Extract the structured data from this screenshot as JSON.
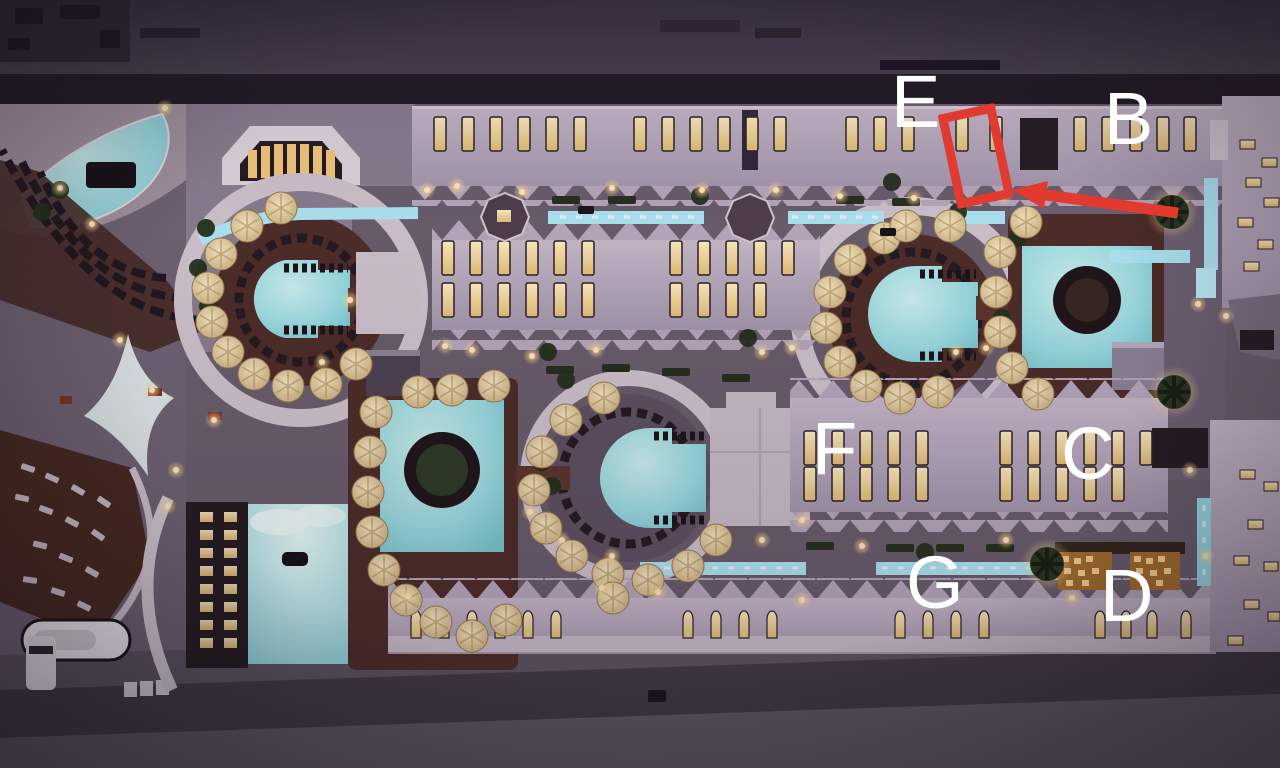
{
  "annotations": {
    "letters": [
      {
        "id": "E",
        "label": "E"
      },
      {
        "id": "B",
        "label": "B"
      },
      {
        "id": "F",
        "label": "F"
      },
      {
        "id": "C",
        "label": "C"
      },
      {
        "id": "G",
        "label": "G"
      },
      {
        "id": "D",
        "label": "D"
      }
    ],
    "marker": {
      "shape": "rotated-rectangle-outline"
    },
    "arrow": {
      "description": "red arrow pointing from right toward the rectangle marker"
    }
  },
  "colors": {
    "annotation_red": "#e03a31",
    "letter_white": "#ffffff",
    "pool_cyan": "#9adde2",
    "canal_blue": "#aee6f4",
    "building_lavender": "#b7a8bc",
    "window_amber": "#f2d79e",
    "deck_wood": "#4c2c27",
    "ground_mauve": "#6a5e6d",
    "night_dark": "#1f1923",
    "road_dark": "#403a44"
  }
}
